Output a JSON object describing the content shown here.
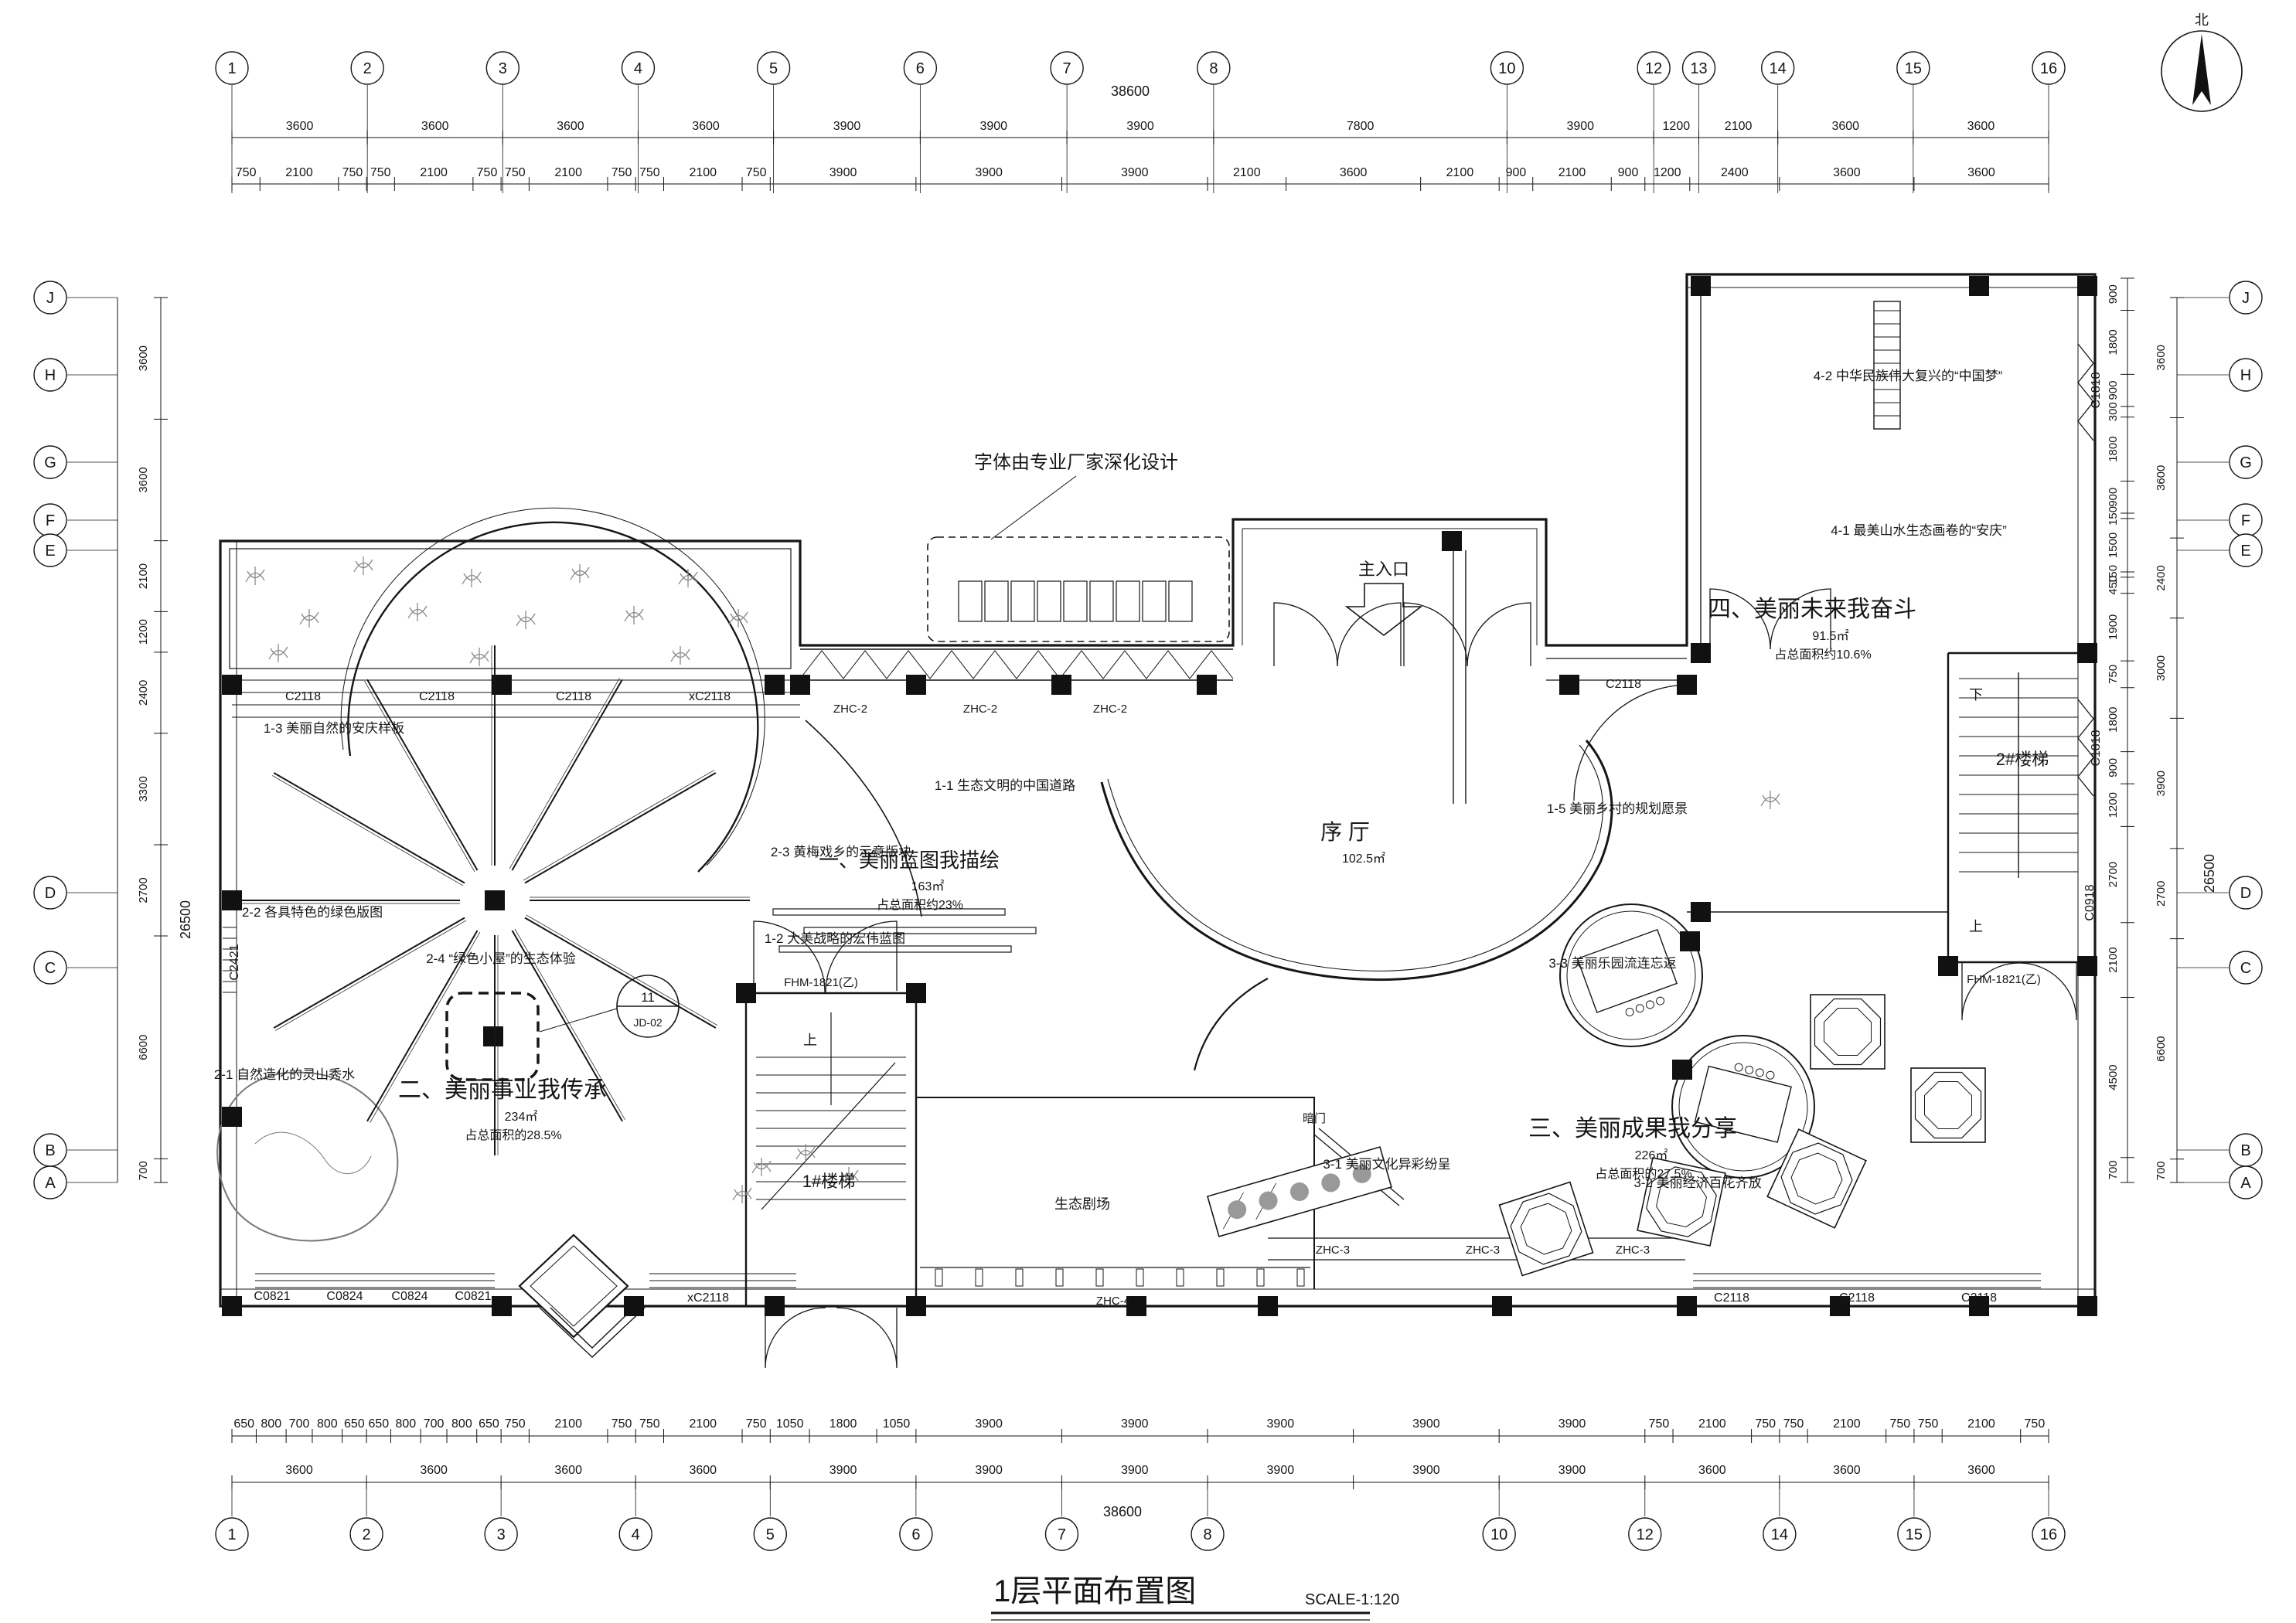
{
  "sheet": {
    "title": "1层平面布置图",
    "scale_label": "SCALE-1:120"
  },
  "compass": {
    "label": "北"
  },
  "grid": {
    "top_labels": [
      "1",
      "2",
      "3",
      "4",
      "5",
      "6",
      "7",
      "8",
      "10",
      "12",
      "13",
      "14",
      "15",
      "16"
    ],
    "bottom_labels": [
      "1",
      "2",
      "3",
      "4",
      "5",
      "6",
      "7",
      "8",
      "10",
      "12",
      "14",
      "15",
      "16"
    ],
    "left_labels": [
      "J",
      "H",
      "G",
      "F",
      "E",
      "D",
      "C",
      "B",
      "A"
    ],
    "right_labels": [
      "J",
      "H",
      "G",
      "F",
      "E",
      "D",
      "C",
      "B",
      "A"
    ]
  },
  "dimensions": {
    "top_overall": "38600",
    "bottom_overall": "38600",
    "left_overall": "26500",
    "right_overall": "26500",
    "top_row1": [
      3600,
      3600,
      3600,
      3600,
      3900,
      3900,
      3900,
      7800,
      3900,
      1200,
      2100,
      3600,
      3600
    ],
    "top_row2": [
      750,
      2100,
      750,
      750,
      2100,
      750,
      750,
      2100,
      750,
      750,
      2100,
      750,
      3900,
      3900,
      3900,
      2100,
      3600,
      2100,
      900,
      2100,
      900,
      1200,
      2400,
      3600,
      3600
    ],
    "bottom_row1": [
      650,
      800,
      700,
      800,
      650,
      650,
      800,
      700,
      800,
      650,
      750,
      2100,
      750,
      750,
      2100,
      750,
      1050,
      1800,
      1050,
      3900,
      3900,
      3900,
      3900,
      3900,
      750,
      2100,
      750,
      750,
      2100,
      750,
      750,
      2100,
      750
    ],
    "bottom_row2": [
      3600,
      3600,
      3600,
      3600,
      3900,
      3900,
      3900,
      3900,
      3900,
      3900,
      3600,
      3600,
      3600
    ],
    "left_chain": [
      3600,
      3600,
      2100,
      1200,
      2400,
      3300,
      2700,
      6600,
      700
    ],
    "right_inner": [
      900,
      1800,
      900,
      300,
      1800,
      900,
      150,
      1500,
      150,
      450,
      1900,
      750,
      1800,
      900,
      1200,
      2700,
      2100,
      4500,
      700
    ],
    "right_outer": [
      3600,
      3600,
      2400,
      3000,
      3900,
      2700,
      6600,
      700
    ]
  },
  "rooms": [
    {
      "name": "序 厅",
      "area": "102.5㎡",
      "pct": ""
    },
    {
      "name": "一、美丽蓝图我描绘",
      "area": "163㎡",
      "pct": "占总面积约23%"
    },
    {
      "name": "二、美丽事业我传承",
      "area": "234㎡",
      "pct": "占总面积的28.5%"
    },
    {
      "name": "三、美丽成果我分享",
      "area": "226㎡",
      "pct": "占总面积的27.5%"
    },
    {
      "name": "四、美丽未来我奋斗",
      "area": "91.5㎡",
      "pct": "占总面积约10.6%"
    },
    {
      "name": "1#楼梯",
      "area": "",
      "pct": ""
    },
    {
      "name": "2#楼梯",
      "area": "",
      "pct": ""
    },
    {
      "name": "生态剧场",
      "area": "",
      "pct": ""
    }
  ],
  "annotations": [
    {
      "no": "1-1",
      "text": "生态文明的中国道路"
    },
    {
      "no": "1-2",
      "text": "大美战略的宏伟蓝图"
    },
    {
      "no": "1-3",
      "text": "美丽自然的安庆样板"
    },
    {
      "no": "1-5",
      "text": "美丽乡村的规划愿景"
    },
    {
      "no": "2-1",
      "text": "自然造化的灵山秀水"
    },
    {
      "no": "2-2",
      "text": "各具特色的绿色版图"
    },
    {
      "no": "2-3",
      "text": "黄梅戏乡的示意版块"
    },
    {
      "no": "2-4",
      "text": "“绿色小屋”的生态体验"
    },
    {
      "no": "3-1",
      "text": "美丽文化异彩纷呈"
    },
    {
      "no": "3-2",
      "text": "美丽经济百花齐放"
    },
    {
      "no": "3-3",
      "text": "美丽乐园流连忘返"
    },
    {
      "no": "4-1",
      "text": "最美山水生态画卷的“安庆”"
    },
    {
      "no": "4-2",
      "text": "中华民族伟大复兴的“中国梦”"
    }
  ],
  "callout": {
    "text": "字体由专业厂家深化设计"
  },
  "entrance": {
    "label": "主入口"
  },
  "detail_bubble": {
    "top": "11",
    "bottom": "JD-02"
  },
  "window_labels": [
    "C2118",
    "C2118",
    "C2118",
    "xC2118",
    "C2118",
    "C2421",
    "C0821",
    "C0824",
    "C0824",
    "C0821",
    "xC2118",
    "C2118",
    "C2118",
    "C2118",
    "C0918",
    "C1818",
    "C1818"
  ],
  "door_labels": [
    "FHM-1821(乙)",
    "FHM-1821(乙)",
    "暗门"
  ],
  "louver_labels": [
    "ZHC-2",
    "ZHC-2",
    "ZHC-2",
    "ZHC-4",
    "ZHC-3",
    "ZHC-3",
    "ZHC-3"
  ],
  "stair_marks": {
    "up": "上",
    "down": "下"
  }
}
